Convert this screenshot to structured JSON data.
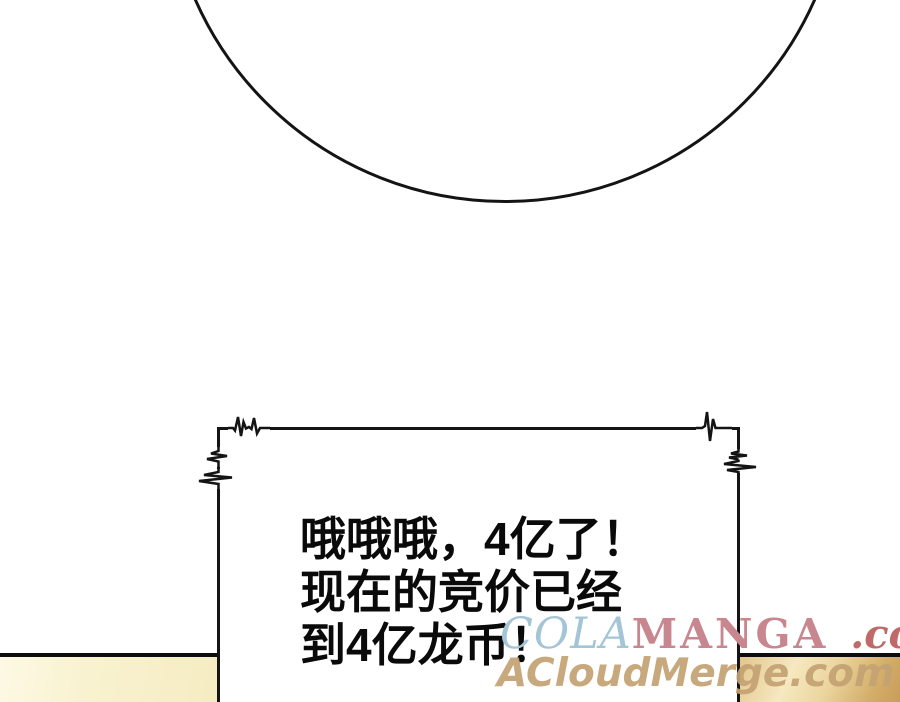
{
  "dialog": {
    "lines": [
      "哦哦哦，4亿了！",
      "现在的竞价已经",
      "到4亿龙币！"
    ]
  },
  "watermarks": {
    "colamanga": {
      "cola": "COLA",
      "manga": "MANGA",
      "domain_suffix": ".com"
    },
    "acloudmerge": "ACloudMerge.com"
  },
  "colors": {
    "ink": "#141414",
    "page_background": "#ffffff",
    "cola_blue": "#a4c5d6",
    "manga_rose": "#c8868e",
    "dotcom_red": "#c06969",
    "acloudmerge_tan": "#c4a273",
    "panel_left_yellow": "#f8f1cd",
    "panel_right_gold": "#d9b272"
  }
}
